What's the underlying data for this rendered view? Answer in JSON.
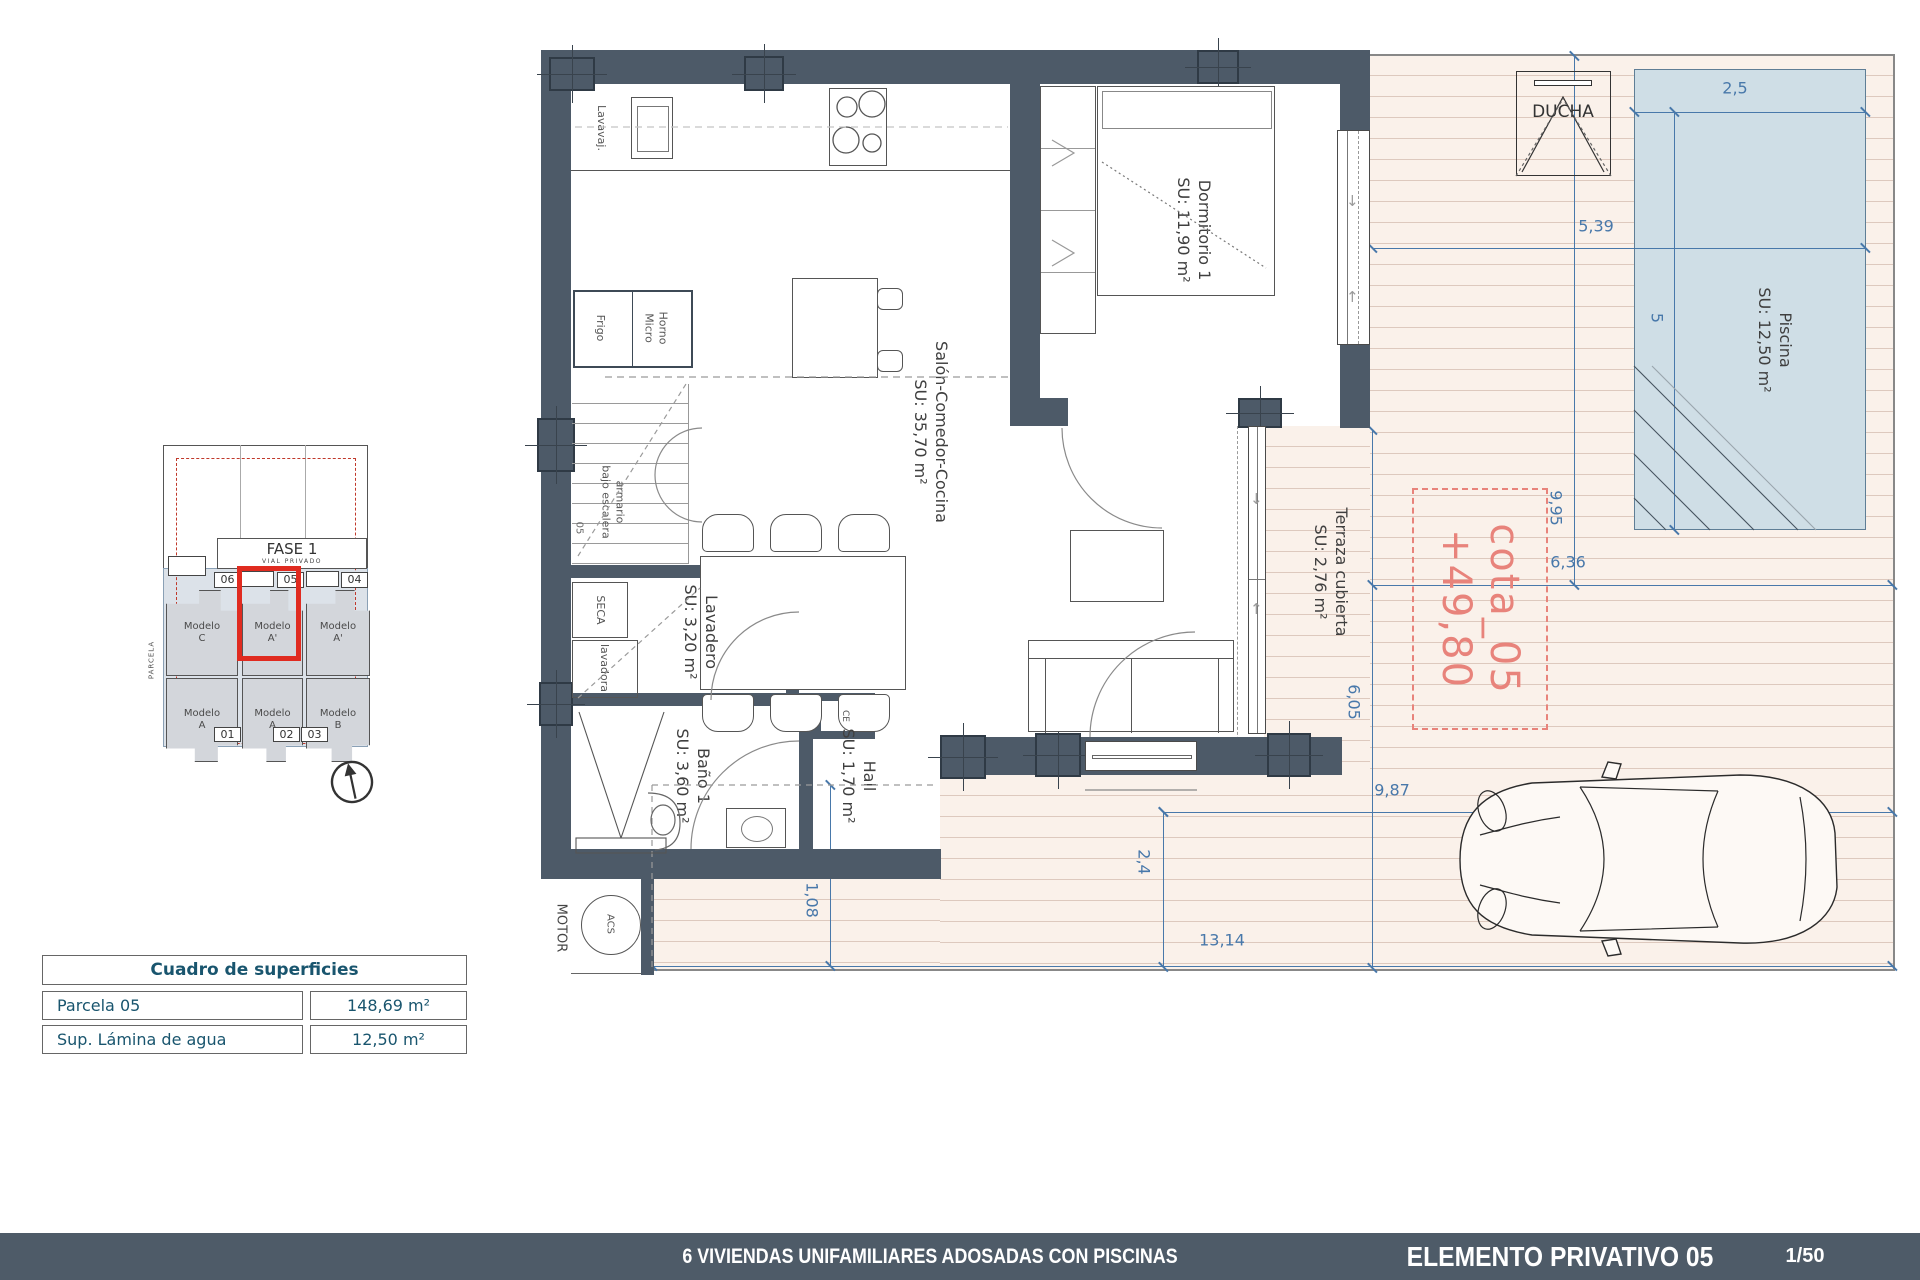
{
  "title_block": {
    "project_title": "6 VIVIENDAS UNIFAMILIARES ADOSADAS CON PISCINAS",
    "sheet_title": "ELEMENTO PRIVATIVO 05",
    "scale": "1/50"
  },
  "surfaces_table": {
    "header": "Cuadro de superficies",
    "rows": [
      {
        "label": "Parcela 05",
        "value": "148,69 m²"
      },
      {
        "label": "Sup. Lámina de agua",
        "value": "12,50 m²"
      }
    ]
  },
  "site_plan": {
    "phase": "FASE 1",
    "street": "VIAL PRIVADO",
    "parcel": "PARCELA",
    "tags_top": [
      "06",
      "05",
      "04"
    ],
    "tags_bottom": [
      "01",
      "02",
      "03"
    ],
    "units_top": [
      {
        "model": "Modelo",
        "variant": "C"
      },
      {
        "model": "Modelo",
        "variant": "A'"
      },
      {
        "model": "Modelo",
        "variant": "A'"
      }
    ],
    "units_bottom": [
      {
        "model": "Modelo",
        "variant": "A"
      },
      {
        "model": "Modelo",
        "variant": "A"
      },
      {
        "model": "Modelo",
        "variant": "B"
      }
    ]
  },
  "plan": {
    "rooms": {
      "dormitorio": {
        "name": "Dormitorio 1",
        "area": "SU: 11,90 m²"
      },
      "salon": {
        "name": "Salón-Comedor-Cocina",
        "area": "SU: 35,70 m²"
      },
      "lavadero": {
        "name": "Lavadero",
        "area": "SU: 3,20 m²"
      },
      "bano": {
        "name": "Baño 1",
        "area": "SU: 3,60 m²"
      },
      "hall": {
        "name": "Hall",
        "area": "SU: 1,70 m²"
      },
      "terraza": {
        "name": "Terraza cubierta",
        "area": "SU: 2,76 m²"
      },
      "piscina": {
        "name": "Piscina",
        "area": "SU: 12,50 m²"
      }
    },
    "fixtures": {
      "ducha": "DUCHA",
      "motor": "MOTOR",
      "acs": "ACS",
      "frigo": "Frigo",
      "horno_l1": "Horno",
      "horno_l2": "Micro",
      "lavavajillas": "Lavavaj.",
      "seca": "SECA",
      "lavadora": "lavadora",
      "armario_l1": "armario",
      "armario_l2": "bajo escalera",
      "stair_tag": "05",
      "ce": "CE"
    },
    "cota": {
      "line1": "cota_05",
      "line2": "+49,80"
    },
    "dims": {
      "pool_width": "2,5",
      "deck_to_pool": "5,39",
      "pool_length": "5",
      "deck_depth": "9,95",
      "terrace_width": "6,36",
      "side_depth": "6,05",
      "drive_width": "9,87",
      "drive_depth": "2,4",
      "plot_width": "13,14",
      "path_width": "1,08"
    }
  },
  "colors": {
    "wall": "#4d5a68",
    "dimension_blue": "#4878aa",
    "highlight_red": "#e02b20",
    "cota_red": "#e8837b",
    "table_text": "#19556e",
    "pool_fill": "#cfdee6",
    "deck_fill": "#faf1ea",
    "deck_line": "#ddc9be",
    "site_units_fill": "#dce2e9",
    "unit_fill": "#d3d6db",
    "titlebar": "#4e5b68"
  }
}
